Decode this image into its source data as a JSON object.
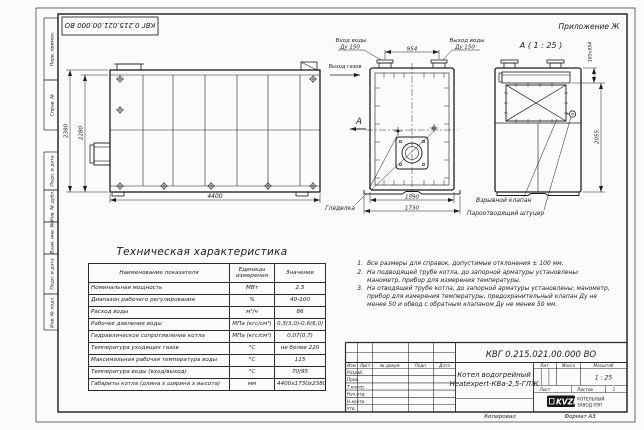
{
  "frame": {
    "stamp_rotated": "КВГ 0.215.021.00.000 ВО",
    "appendix": "Приложение Ж",
    "margin_labels": [
      "Перв. примен.",
      "Справ. №",
      "Подп. и дата",
      "Инв. № дубл.",
      "Взам. инв. №",
      "Подп. и дата",
      "Инв. № подл."
    ],
    "copied": "Копировал",
    "format": "Формат А3"
  },
  "views": {
    "side": {
      "dim_outer_height": "2380",
      "dim_inner_height": "2280",
      "dim_length": "4400"
    },
    "front": {
      "inlet_line1": "Вход воды",
      "inlet_line2": "Ду 150",
      "outlet_line1": "Выход воды",
      "outlet_line2": "Ду 150",
      "gas_label": "Выход газов",
      "section_letter": "А",
      "dim_stubs": "954",
      "dim_inner_width": "1590",
      "dim_outer_width": "1730",
      "sight_label": "Гляделка"
    },
    "section": {
      "title": "А ( 1 : 25 )",
      "dim_top": "185х954",
      "dim_body": "2055",
      "valve_label": "Взрывной клапан",
      "nozzle_label": "Пароотводящий штуцер"
    }
  },
  "spec": {
    "title": "Техническая характеристика",
    "headers": {
      "name": "Наименование показателя",
      "units": "Единицы измерения",
      "value": "Значение"
    },
    "rows": [
      {
        "name": "Номинальная мощность",
        "units": "МВт",
        "value": "2,5"
      },
      {
        "name": "Диапазон рабочего регулирования",
        "units": "%",
        "value": "40-100"
      },
      {
        "name": "Расход воды",
        "units": "м³/ч",
        "value": "86"
      },
      {
        "name": "Рабочее давление воды",
        "units": "МПа (кгс/см²)",
        "value": "0,3(3,0)-0,6(6,0)"
      },
      {
        "name": "Гидравлическое сопротивление котла",
        "units": "МПа (кгс/см²)",
        "value": "0,07(0,7)"
      },
      {
        "name": "Температура уходящих газов",
        "units": "°С",
        "value": "не более 220"
      },
      {
        "name": "Максимальная рабочая температура воды",
        "units": "°С",
        "value": "115"
      },
      {
        "name": "Температура воды (вход/выход)",
        "units": "°С",
        "value": "70/95"
      },
      {
        "name": "Габариты котла (длина х ширина х высота)",
        "units": "мм",
        "value": "4400х1730х2380"
      }
    ]
  },
  "notes": [
    {
      "num": "1.",
      "text": "Все размеры для справок, допустимые отклонения ± 100 мм."
    },
    {
      "num": "2.",
      "text": "На подводящей трубе котла, до запорной арматуры установлены: манометр, прибор для измерения температуры."
    },
    {
      "num": "3.",
      "text": "На отводящей трубе котла, до запорной арматуры установлены: манометр, прибор для измерения температуры, предохранительный клапан Ду не менее 50 и обвод с обратным клапаном Ду не менее 50 мм."
    }
  ],
  "title_block": {
    "doc_number": "КВГ 0.215.021.00.000 ВО",
    "product_line1": "Котел водогрейный",
    "product_line2": "Heatexpert-КВа-2,5-ГЛЖ",
    "col_headers": [
      "Изм",
      "Лист",
      "№ докум.",
      "Подп.",
      "Дата"
    ],
    "row_labels": [
      "Разраб.",
      "Пров.",
      "Т.контр.",
      "Нач.отд.",
      "Н.контр.",
      "Утв."
    ],
    "lit": "Лит.",
    "mass": "Масса",
    "scale": "Масштаб",
    "scale_value": "1 : 25",
    "sheet": "Лист",
    "sheets": "Листов",
    "sheets_value": "1",
    "logo": "KVZR",
    "logo_line1": "КОТЕЛЬНЫЙ",
    "logo_line2": "ЗАВОД РЭП"
  }
}
